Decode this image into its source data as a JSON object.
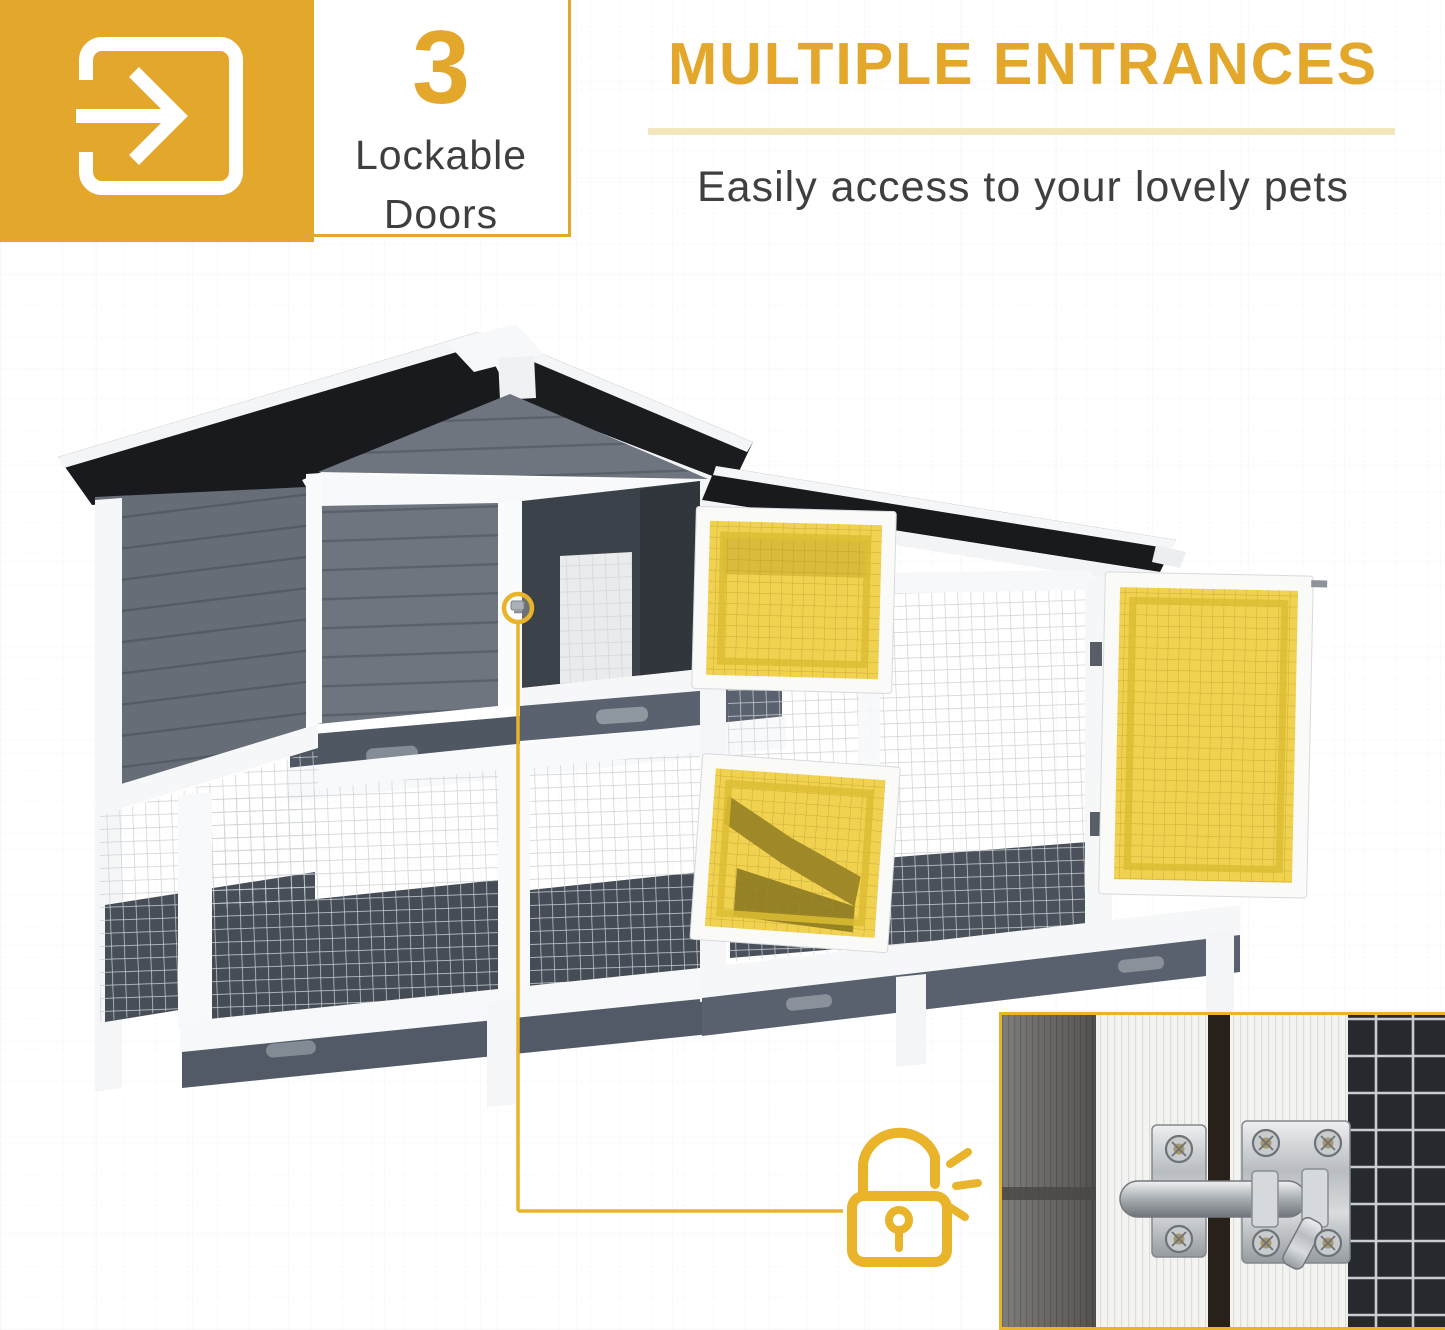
{
  "badge": {
    "value": "3",
    "label_line1": "Lockable",
    "label_line2": "Doors"
  },
  "header": {
    "title": "MULTIPLE ENTRANCES",
    "subtitle": "Easily access to your lovely pets"
  },
  "icons": {
    "enter_icon": "arrow-entering-doorway",
    "lock_icon": "open-padlock-with-click-lines",
    "latch_marker_icon": "circled-door-latch"
  },
  "callout": {
    "marker_target": "upper-hutch-door-latch",
    "connects_to": "latch-closeup-photo-inset"
  },
  "colors": {
    "accent_gold": "#E3A72C",
    "divider_pale_gold": "#F3E6BC",
    "door_highlight_yellow": "#F0CF47",
    "roof_black": "#191A1D",
    "wood_gray": "#6E757F",
    "interior_dark": "#3C424A",
    "trim_white": "#F8F9FA",
    "text_dark": "#3E3E3E"
  }
}
